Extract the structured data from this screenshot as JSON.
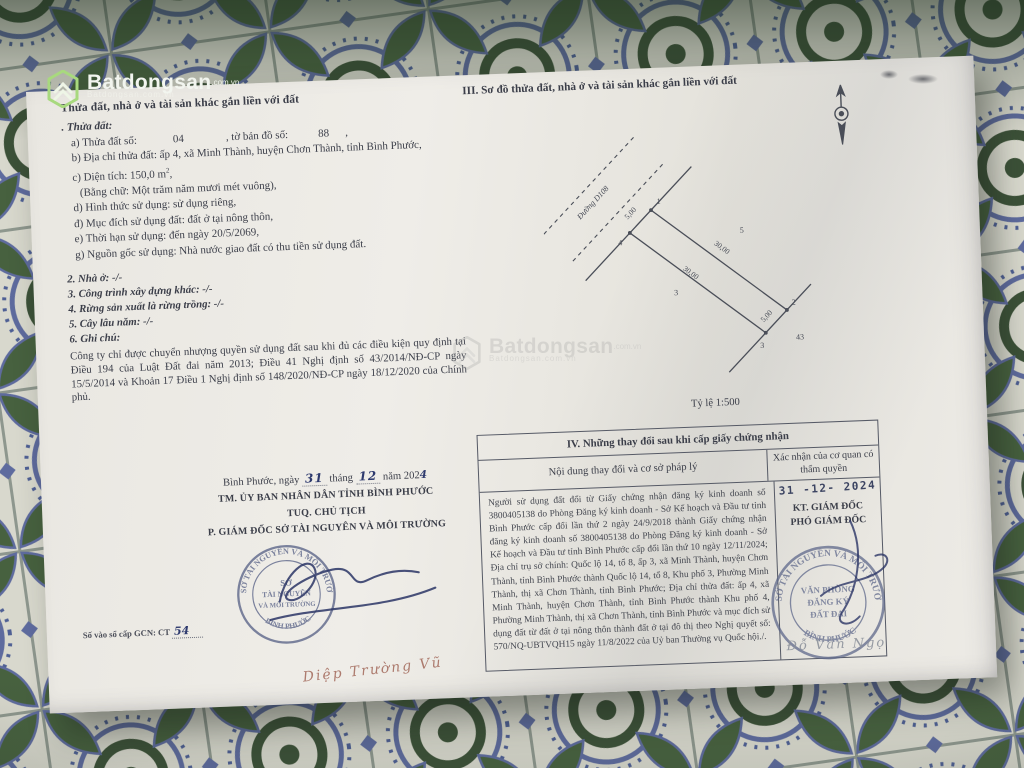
{
  "watermark": {
    "brand": "Batdongsan",
    "domain": ".com.vn",
    "tagline": "Batdongsan.com.vn"
  },
  "section_ii": {
    "title": "Thửa đất, nhà ở và tài sản khác gắn liền với đất",
    "subtitle": ". Thửa đất:",
    "line_a": {
      "label_1": "a) Thửa đất số:",
      "parcel_no": "04",
      "label_2": ", tờ bản đồ số:",
      "map_no": "88",
      "suffix": ","
    },
    "line_b": "b) Địa chỉ thửa đất: ấp 4, xã Minh Thành, huyện Chơn Thành, tỉnh Bình Phước,",
    "line_c": {
      "label": "c) Diện tích: 150,0 m",
      "sup": "2",
      "suffix": ","
    },
    "line_c_words": "(Bằng chữ: Một trăm năm mươi mét vuông),",
    "line_d": "d) Hình thức sử dụng: sử dụng riêng,",
    "line_dd": "đ) Mục đích sử dụng đất: đất ở tại nông thôn,",
    "line_e": "e) Thời hạn sử dụng: đến ngày 20/5/2069,",
    "line_g": "g) Nguồn gốc sử dụng: Nhà nước giao đất có thu tiền sử dụng đất.",
    "item_2": "2. Nhà ở: -/-",
    "item_3": "3. Công trình xây dựng khác: -/-",
    "item_4": "4. Rừng sản xuất là rừng trồng: -/-",
    "item_5": "5. Cây lâu năm: -/-",
    "item_6": "6. Ghi chú:",
    "note": "Công ty chỉ được chuyển nhượng quyền sử dụng đất sau khi đủ các điều kiện quy định tại Điều 194 của Luật Đất đai năm 2013; Điều 41 Nghị định số 43/2014/NĐ-CP ngày 15/5/2014 và Khoản 17 Điều 1 Nghị định số 148/2020/NĐ-CP ngày 18/12/2020 của Chính phủ."
  },
  "signature_left": {
    "date_prefix": "Bình Phước, ngày",
    "day": "31",
    "thang": "tháng",
    "month": "12",
    "nam": "năm",
    "year_print": "202",
    "year_hand": "4",
    "line_1": "TM. ỦY BAN NHÂN DÂN TỈNH BÌNH PHƯỚC",
    "line_2": "TUQ. CHỦ TỊCH",
    "line_3": "P. GIÁM ĐỐC SỞ TÀI NGUYÊN VÀ MÔI TRƯỜNG",
    "stamp": {
      "arc_top": "SỞ TÀI NGUYÊN VÀ MÔI TRƯỜNG",
      "center_1": "SỞ",
      "center_2": "TÀI NGUYÊN",
      "center_3": "VÀ MÔI TRƯỜNG",
      "arc_bottom": "BÌNH PHƯỚC"
    },
    "signed_name": "Diệp Trường Vũ"
  },
  "gcn_number": {
    "label": "Số vào sổ cấp GCN: CT",
    "value": "54"
  },
  "section_iii": {
    "title": "III. Sơ đồ thửa đất, nhà ở và tài sản khác gắn liền với đất",
    "scale": "Tỷ lệ 1:500",
    "diagram": {
      "road_label": "Đường D108",
      "corner_1": "1",
      "corner_2": "2",
      "corner_3": "3",
      "corner_4": "4",
      "dim_top": "5,00",
      "dim_long_upper": "30,00",
      "dim_long_lower": "30,00",
      "dim_bottom": "5,00",
      "adjacent_parcel_right": "5",
      "adjacent_parcel_left": "3",
      "adjacent_parcel_bottom": "43"
    }
  },
  "section_iv": {
    "title": "IV. Những thay đổi sau khi cấp giấy chứng nhận",
    "col_1_header": "Nội dung thay đổi và cơ sở pháp lý",
    "col_2_header": "Xác nhận của cơ quan có thẩm quyền",
    "body": "Người sử dụng đất đổi từ Giấy chứng nhận đăng ký kinh doanh số 3800405138 do Phòng Đăng ký kinh doanh - Sở Kế hoạch và Đầu tư tỉnh Bình Phước cấp đổi lần thứ 2 ngày 24/9/2018 thành Giấy chứng nhận đăng ký kinh doanh số 3800405138 do Phòng Đăng ký kinh doanh - Sở Kế hoạch và Đầu tư tỉnh Bình Phước cấp đổi lần thứ 10 ngày 12/11/2024; Địa chỉ trụ sở chính: Quốc lộ 14, tổ 8, ấp 3, xã Minh Thành, huyện Chơn Thành, tỉnh Bình Phước thành Quốc lộ 14, tổ 8, Khu phố 3, Phường Minh Thành, thị xã Chơn Thành, tỉnh Bình Phước; Địa chỉ thửa đất: ấp 4, xã Minh Thành, huyện Chơn Thành, tỉnh Bình Phước thành Khu phố 4, Phường Minh Thành, thị xã Chơn Thành, tỉnh Bình Phước và mục đích sử dụng đất từ đất ở tại nông thôn thành đất ở tại đô thị theo Nghị quyết số: 570/NQ-UBTVQH15 ngày 11/8/2022 của Uỷ ban Thường vụ Quốc hội./.",
    "confirm_date": "31 -12- 2024",
    "kt_line_1": "KT. GIÁM ĐỐC",
    "kt_line_2": "PHÓ GIÁM ĐỐC",
    "stamp": {
      "arc_top": "SỞ TÀI NGUYÊN VÀ MÔI TRƯỜNG",
      "center_1": "VĂN PHÒNG",
      "center_2": "ĐĂNG KÝ",
      "center_3": "ĐẤT ĐAI",
      "arc_bottom": "BÌNH PHƯỚC"
    },
    "signed_name": "Đỗ Văn Ngọ"
  },
  "colors": {
    "paper": "#edebe6",
    "ink": "#3b3e49",
    "stamp_blue": "#5a6488",
    "handwriting_ink": "#2e3a6e",
    "brand_green": "#7ac143",
    "tile_blue": "#5e6b9e",
    "tile_green": "#47613f"
  }
}
